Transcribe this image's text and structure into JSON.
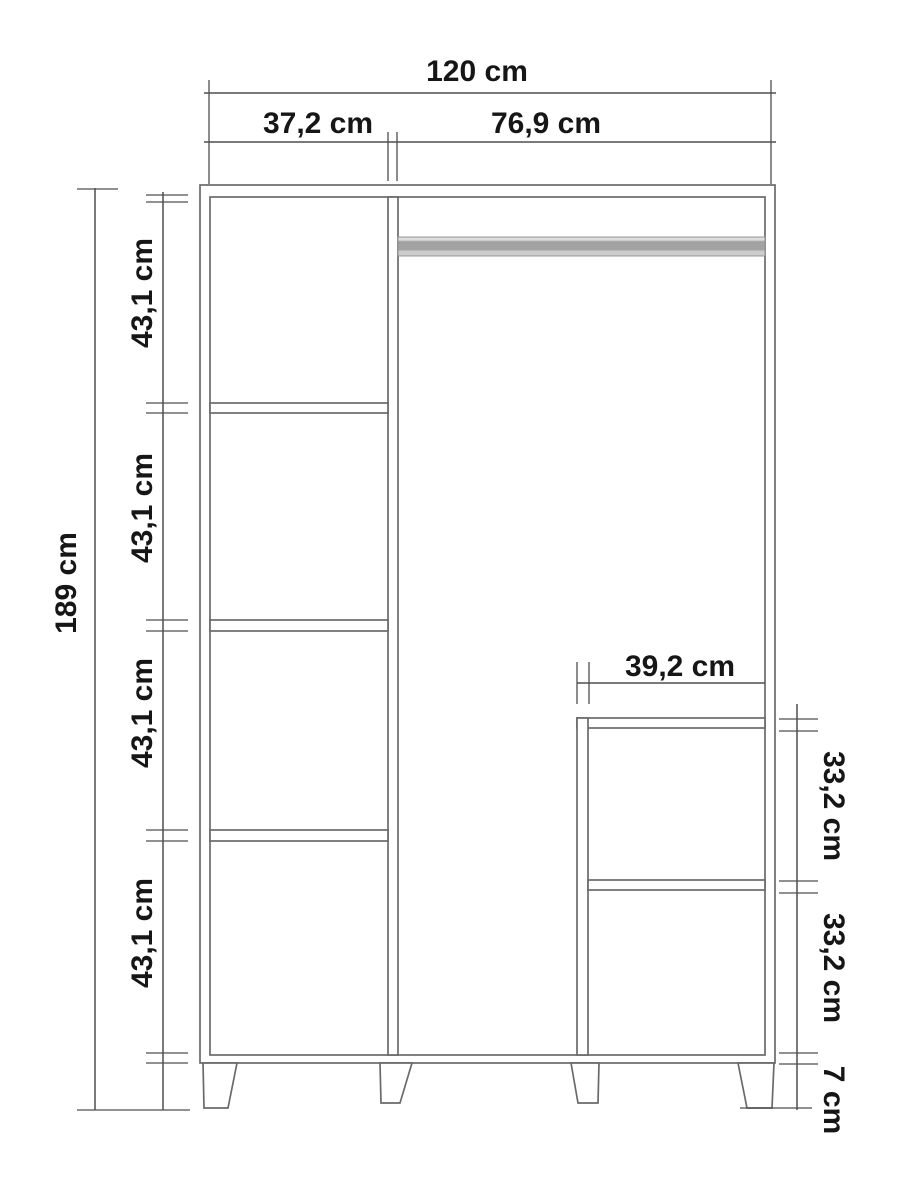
{
  "diagram": {
    "type": "furniture-technical-drawing",
    "subject": "wardrobe front elevation with interior shelves, hanging rail and legs",
    "unit": "cm"
  },
  "labels": {
    "total_width": "120 cm",
    "left_section_width": "37,2 cm",
    "right_section_width": "76,9 cm",
    "total_height": "189 cm",
    "left_shelf_1_height": "43,1 cm",
    "left_shelf_2_height": "43,1 cm",
    "left_shelf_3_height": "43,1 cm",
    "left_shelf_4_height": "43,1 cm",
    "inner_compartment_width": "39,2 cm",
    "inner_compartment_upper_height": "33,2 cm",
    "inner_compartment_lower_height": "33,2 cm",
    "leg_height": "7 cm"
  },
  "colors": {
    "line": "#6a6a6a",
    "dim_line": "#4f4f4f",
    "text": "#161616",
    "rail_mid": "#a2a2a2",
    "rail_light": "#dedede",
    "background": "#ffffff"
  }
}
